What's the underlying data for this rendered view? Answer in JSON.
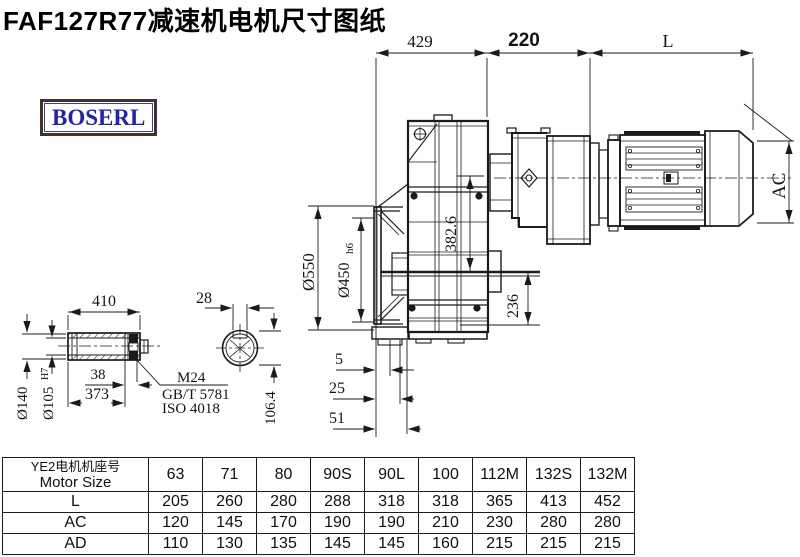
{
  "title": "FAF127R77减速机电机尺寸图纸",
  "logo": {
    "text": "BOSERL"
  },
  "drawing": {
    "dims": {
      "a429": "429",
      "a220": "220",
      "aL": "L",
      "ac": "AC",
      "v3826": "382.6",
      "v236": "236",
      "d550": "Ø550",
      "d450": "Ø450",
      "d450t": "h6",
      "o5": "5",
      "o25": "25",
      "o51": "51",
      "s410": "410",
      "k28": "28",
      "s38": "38",
      "s373": "373",
      "d140": "Ø140",
      "d105": "Ø105",
      "d105t": "H7",
      "k1064": "106.4",
      "m24": "M24",
      "std1": "GB/T 5781",
      "std2": "ISO 4018"
    }
  },
  "table": {
    "header_cn": "YE2电机机座号",
    "header_en": "Motor Size",
    "columns": [
      "63",
      "71",
      "80",
      "90S",
      "90L",
      "100",
      "112M",
      "132S",
      "132M"
    ],
    "rows": [
      {
        "label": "L",
        "values": [
          "205",
          "260",
          "280",
          "288",
          "318",
          "318",
          "365",
          "413",
          "452"
        ]
      },
      {
        "label": "AC",
        "values": [
          "120",
          "145",
          "170",
          "190",
          "190",
          "210",
          "230",
          "280",
          "280"
        ]
      },
      {
        "label": "AD",
        "values": [
          "110",
          "130",
          "135",
          "145",
          "145",
          "160",
          "215",
          "215",
          "215"
        ]
      }
    ]
  }
}
